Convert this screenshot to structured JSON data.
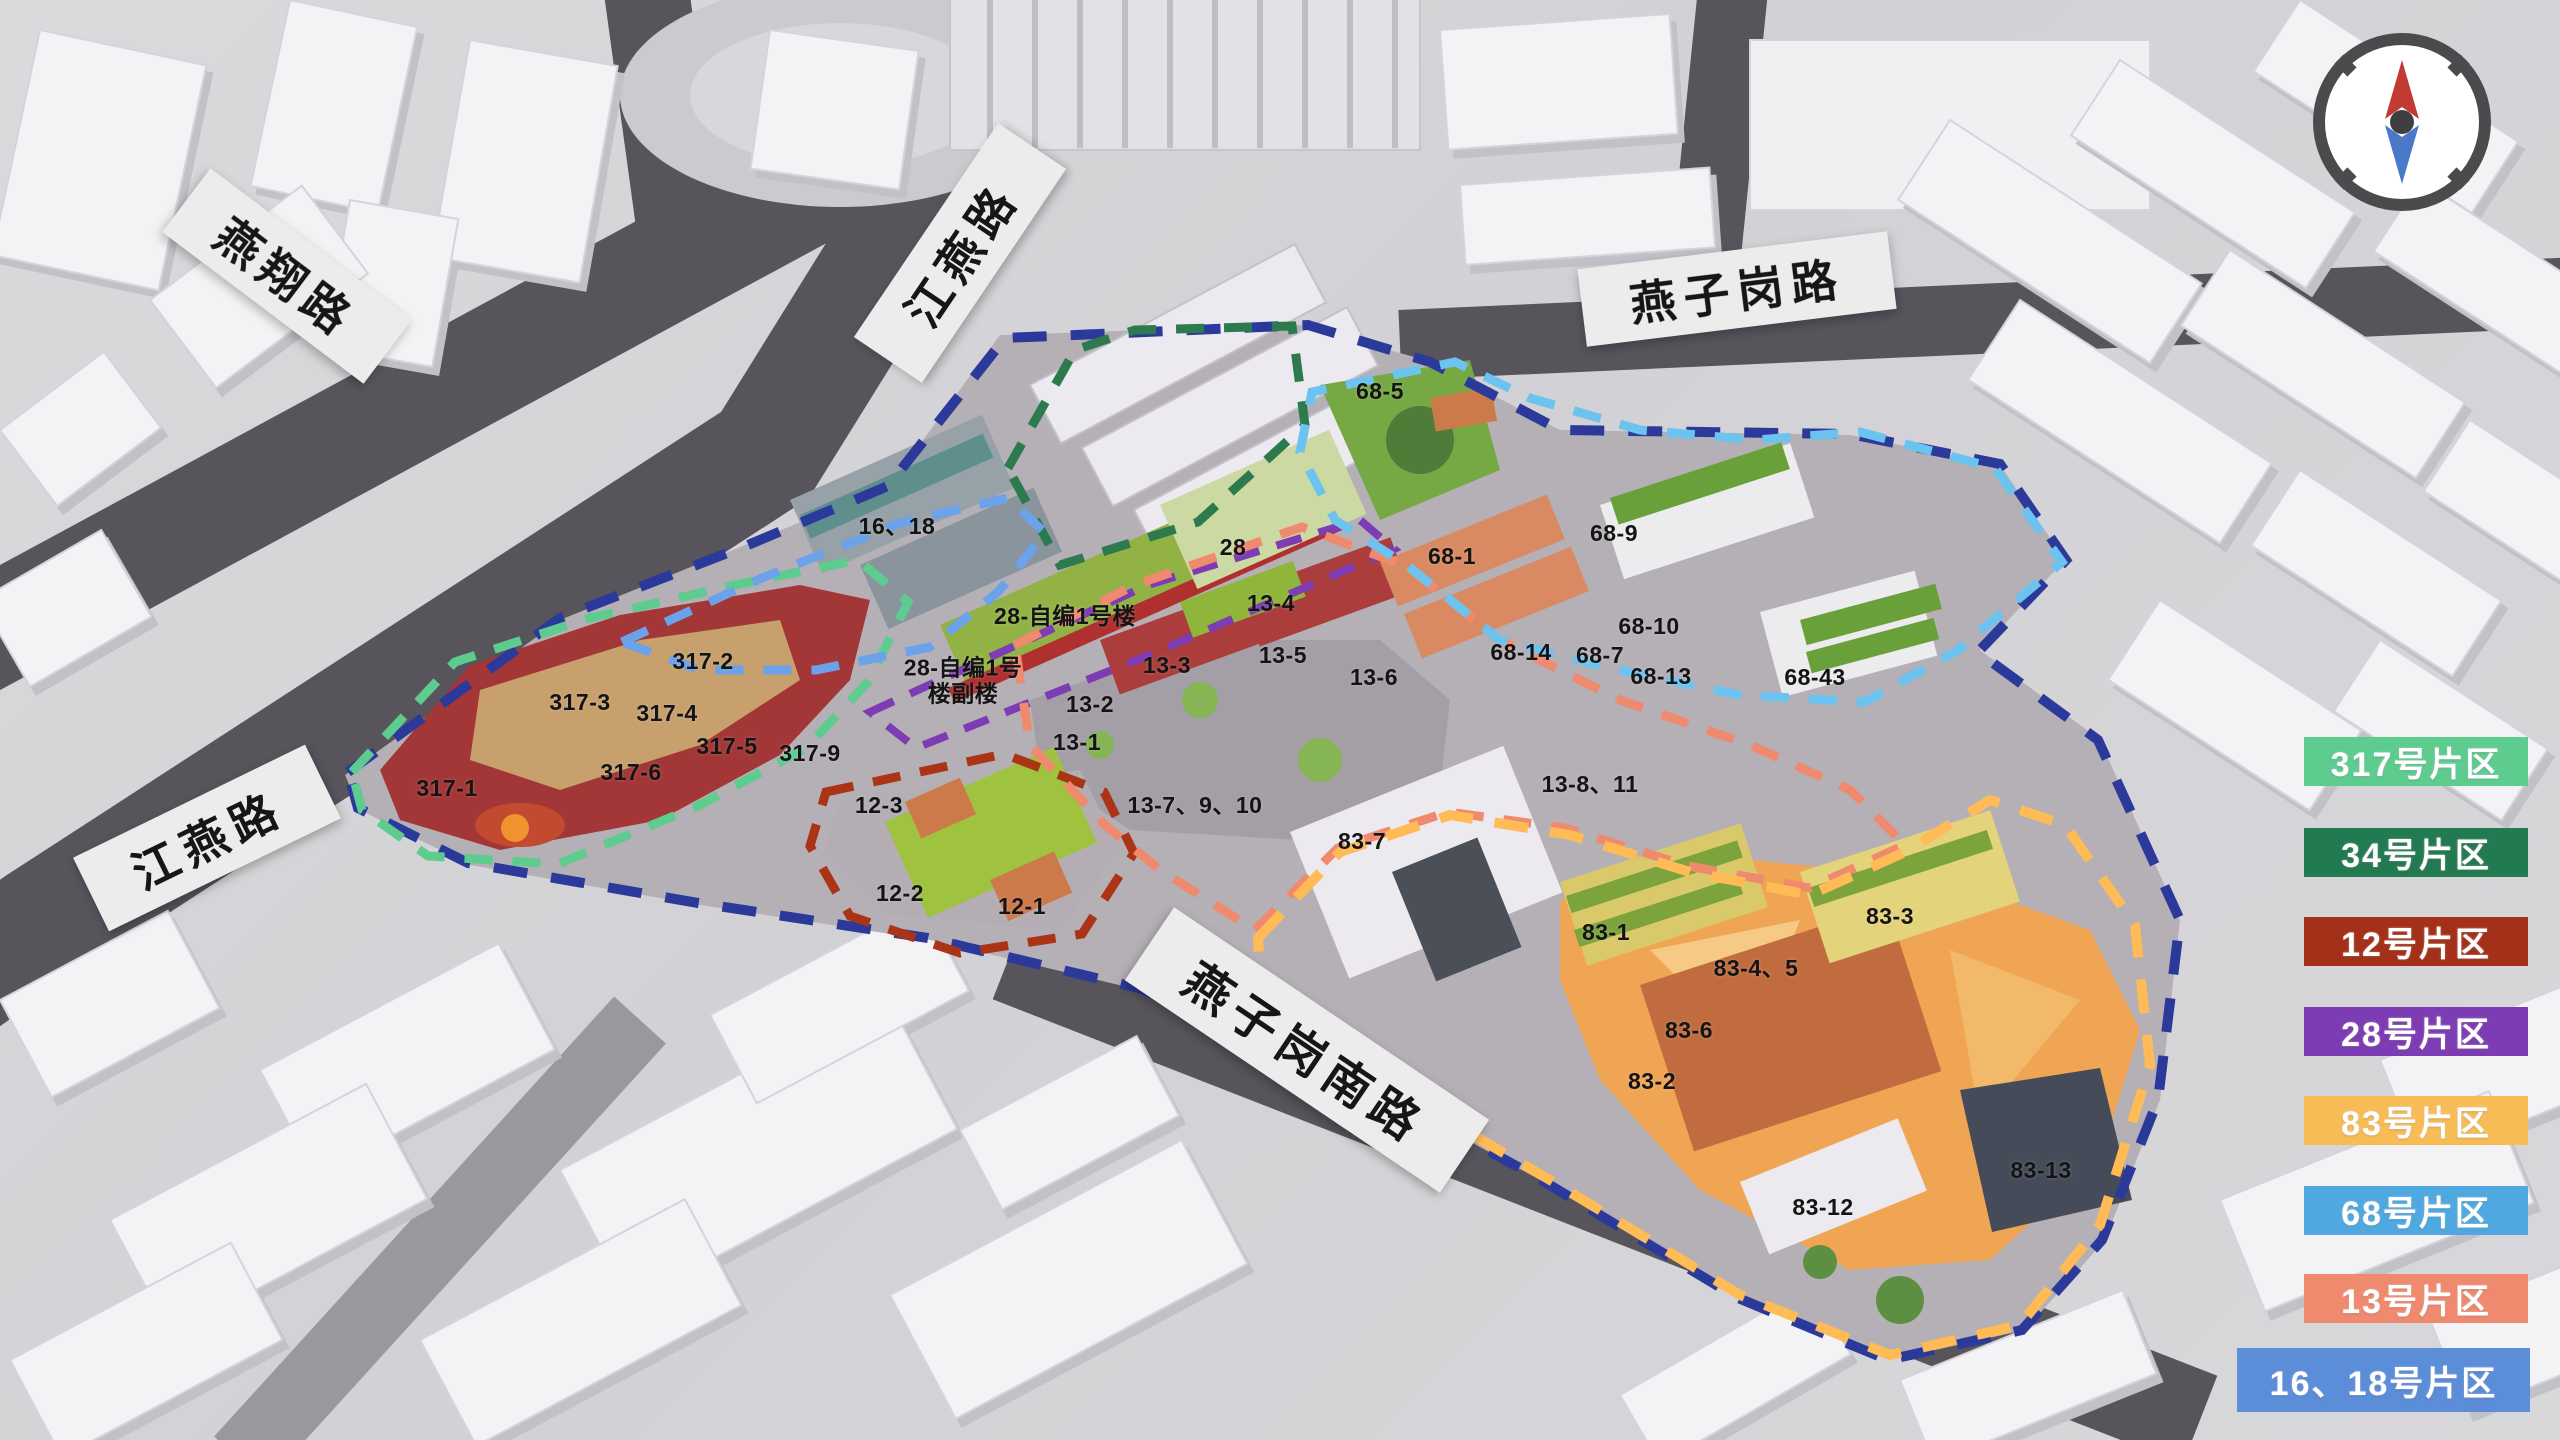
{
  "map": {
    "type": "3d-masterplan-render",
    "compass": {
      "ring": "#4b4b4e",
      "north": "#c23a33",
      "south": "#4a79c8",
      "hub": "#3f3f42"
    },
    "road_labels": [
      {
        "name": "yanxiang-road",
        "text": "燕翔路",
        "x": 287,
        "y": 276,
        "rot": 37,
        "w": 252,
        "h": 80,
        "font": 46
      },
      {
        "name": "jiangyan-road-north",
        "text": "江燕路",
        "x": 960,
        "y": 253,
        "rot": -56,
        "w": 258,
        "h": 82,
        "font": 46
      },
      {
        "name": "yanzigang-road",
        "text": "燕子岗路",
        "x": 1737,
        "y": 289,
        "rot": -7,
        "w": 312,
        "h": 78,
        "font": 46
      },
      {
        "name": "jiangyan-road-west",
        "text": "江燕路",
        "x": 207,
        "y": 838,
        "rot": -26,
        "w": 258,
        "h": 82,
        "font": 46
      },
      {
        "name": "yanzigang-south-road",
        "text": "燕子岗南路",
        "x": 1307,
        "y": 1050,
        "rot": 34,
        "w": 380,
        "h": 88,
        "font": 48
      }
    ],
    "building_labels": [
      {
        "text": "317-1",
        "x": 447,
        "y": 789
      },
      {
        "text": "317-2",
        "x": 703,
        "y": 662
      },
      {
        "text": "317-3",
        "x": 580,
        "y": 703
      },
      {
        "text": "317-4",
        "x": 667,
        "y": 714
      },
      {
        "text": "317-5",
        "x": 727,
        "y": 747
      },
      {
        "text": "317-6",
        "x": 631,
        "y": 773
      },
      {
        "text": "317-9",
        "x": 810,
        "y": 754
      },
      {
        "text": "12-1",
        "x": 1022,
        "y": 907
      },
      {
        "text": "12-2",
        "x": 900,
        "y": 894
      },
      {
        "text": "12-3",
        "x": 879,
        "y": 806
      },
      {
        "text": "13-1",
        "x": 1077,
        "y": 743
      },
      {
        "text": "13-2",
        "x": 1090,
        "y": 705
      },
      {
        "text": "13-3",
        "x": 1167,
        "y": 666
      },
      {
        "text": "13-4",
        "x": 1271,
        "y": 604
      },
      {
        "text": "13-5",
        "x": 1283,
        "y": 656
      },
      {
        "text": "13-6",
        "x": 1374,
        "y": 678
      },
      {
        "text": "13-7、9、10",
        "x": 1195,
        "y": 806
      },
      {
        "text": "13-8、11",
        "x": 1590,
        "y": 785
      },
      {
        "text": "16、18",
        "x": 897,
        "y": 527
      },
      {
        "text": "28",
        "x": 1233,
        "y": 548
      },
      {
        "text": "28-自编1号楼",
        "x": 1065,
        "y": 617
      },
      {
        "text": "28-自编1号\n楼副楼",
        "x": 963,
        "y": 681
      },
      {
        "text": "68-1",
        "x": 1452,
        "y": 557
      },
      {
        "text": "68-5",
        "x": 1380,
        "y": 392
      },
      {
        "text": "68-7",
        "x": 1600,
        "y": 656
      },
      {
        "text": "68-9",
        "x": 1614,
        "y": 534
      },
      {
        "text": "68-10",
        "x": 1649,
        "y": 627
      },
      {
        "text": "68-13",
        "x": 1661,
        "y": 677
      },
      {
        "text": "68-14",
        "x": 1521,
        "y": 653
      },
      {
        "text": "68-43",
        "x": 1815,
        "y": 678
      },
      {
        "text": "83-1",
        "x": 1606,
        "y": 933
      },
      {
        "text": "83-2",
        "x": 1652,
        "y": 1082
      },
      {
        "text": "83-3",
        "x": 1890,
        "y": 917
      },
      {
        "text": "83-4、5",
        "x": 1756,
        "y": 969
      },
      {
        "text": "83-6",
        "x": 1689,
        "y": 1031
      },
      {
        "text": "83-7",
        "x": 1362,
        "y": 842
      },
      {
        "text": "83-12",
        "x": 1823,
        "y": 1208
      },
      {
        "text": "83-13",
        "x": 2041,
        "y": 1171
      }
    ]
  },
  "legend": {
    "items": [
      {
        "label": "317号片区",
        "color": "#5ecb8f",
        "x": 2304,
        "y": 737,
        "w": 224,
        "h": 49
      },
      {
        "label": "34号片区",
        "color": "#227a50",
        "x": 2304,
        "y": 828,
        "w": 224,
        "h": 49
      },
      {
        "label": "12号片区",
        "color": "#a53019",
        "x": 2304,
        "y": 917,
        "w": 224,
        "h": 49
      },
      {
        "label": "28号片区",
        "color": "#7d3cb3",
        "x": 2304,
        "y": 1007,
        "w": 224,
        "h": 49
      },
      {
        "label": "83号片区",
        "color": "#f8bc57",
        "x": 2304,
        "y": 1096,
        "w": 224,
        "h": 49
      },
      {
        "label": "68号片区",
        "color": "#4fa9e0",
        "x": 2304,
        "y": 1186,
        "w": 224,
        "h": 49
      },
      {
        "label": "13号片区",
        "color": "#ef8a6f",
        "x": 2304,
        "y": 1274,
        "w": 224,
        "h": 49
      },
      {
        "label": "16、18号片区",
        "color": "#5b8dd9",
        "x": 2237,
        "y": 1348,
        "w": 293,
        "h": 64
      }
    ]
  }
}
